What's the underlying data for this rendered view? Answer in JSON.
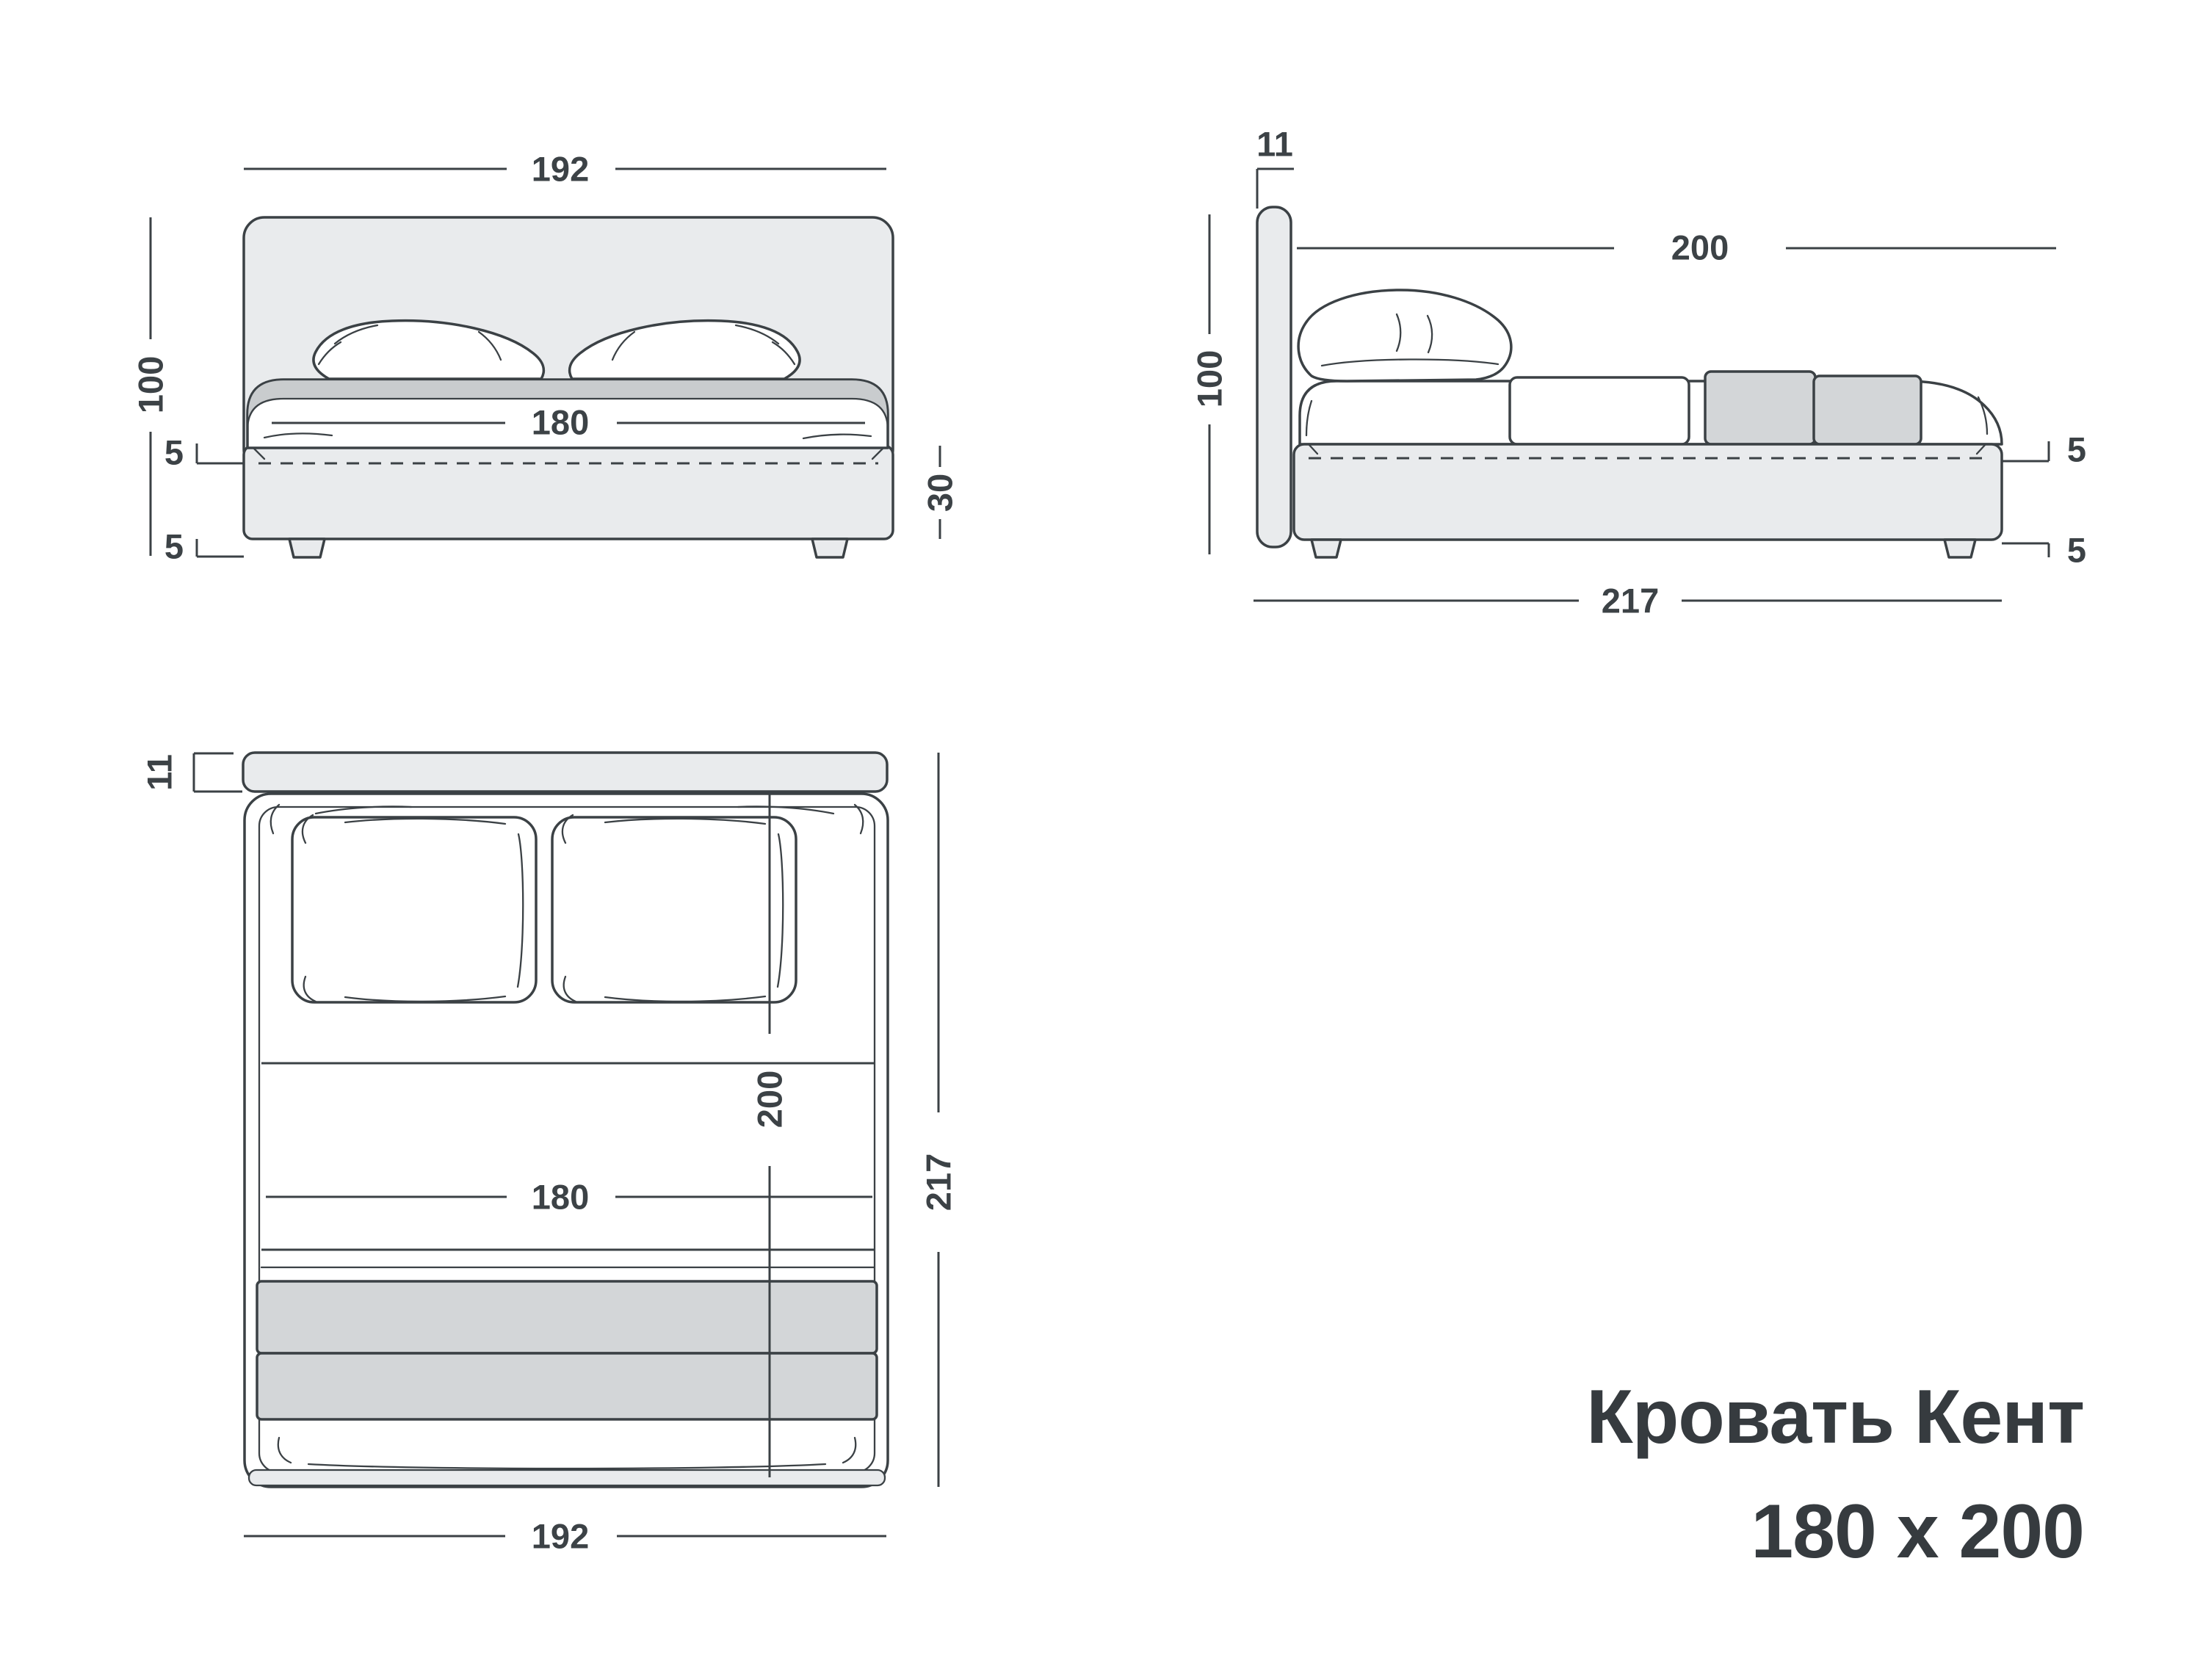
{
  "title": {
    "line1": "Кровать Кент",
    "line2": "180 x 200"
  },
  "colors": {
    "line": "#3b4145",
    "text": "#3c4246",
    "title_text": "#363b3f",
    "panel_fill": "#e9ebed",
    "mattress_edge_fill": "#c9ccce",
    "blanket_fill": "#d3d6d8",
    "background": "#ffffff"
  },
  "views": {
    "front": {
      "width_top": "192",
      "height_left": "100",
      "platform_gap": "5",
      "leg_height": "5",
      "mattress_width": "180",
      "base_height": "30"
    },
    "side": {
      "headboard_thickness": "11",
      "mattress_length": "200",
      "height_left": "100",
      "platform_gap": "5",
      "leg_height": "5",
      "total_length": "217"
    },
    "top": {
      "headboard_thickness": "11",
      "mattress_length": "200",
      "mattress_width": "180",
      "total_length": "217",
      "total_width": "192"
    }
  }
}
